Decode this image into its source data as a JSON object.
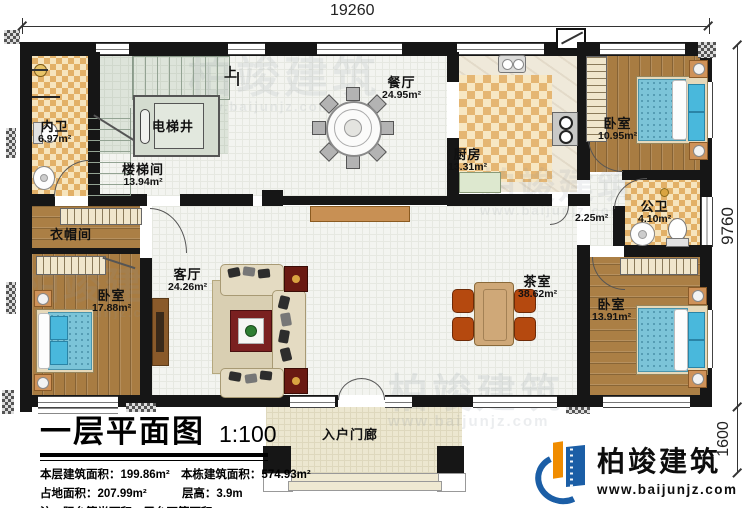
{
  "plan": {
    "title": "一层平面图",
    "scale": "1:100",
    "stats": {
      "line1_left": "本层建筑面积：199.86m²",
      "line1_right": "本栋建筑面积：574.93m²",
      "line2_left": "占地面积：207.99m²",
      "line2_right": "层高：3.9m",
      "note": "注：阳台算半面积，露台不算面积"
    }
  },
  "dimensions": {
    "top_width": "19260",
    "right_height": "9760",
    "porch_depth": "1600"
  },
  "rooms": [
    {
      "name": "内卫",
      "area": "6.97m²"
    },
    {
      "name": "楼梯间",
      "area": "13.94m²"
    },
    {
      "name": "电梯井",
      "area": ""
    },
    {
      "name": "餐厅",
      "area": "24.95m²"
    },
    {
      "name": "厨房",
      "area": "13.31m²"
    },
    {
      "name": "卧室",
      "area": "10.95m²"
    },
    {
      "name": "公卫",
      "area": "4.10m²"
    },
    {
      "name": "",
      "area": "2.25m²"
    },
    {
      "name": "衣帽间",
      "area": ""
    },
    {
      "name": "卧室",
      "area": "17.88m²"
    },
    {
      "name": "客厅",
      "area": "24.26m²"
    },
    {
      "name": "茶室",
      "area": "38.62m²"
    },
    {
      "name": "卧室",
      "area": "13.91m²"
    },
    {
      "name": "入户门廊",
      "area": ""
    }
  ],
  "stairs": {
    "up_label": "上"
  },
  "branding": {
    "company": "柏竣建筑",
    "website": "www.baijunjz.com"
  },
  "colors": {
    "wall": "#161616",
    "wood_floor": "#a87c42",
    "tile": "#e5b673",
    "bed_blue": "#7cc4d8",
    "tea_chair_red": "#b5490f",
    "logo_blue": "#1b5ea6",
    "logo_orange": "#f08c00",
    "watermark_gray": "#8a94a0"
  }
}
